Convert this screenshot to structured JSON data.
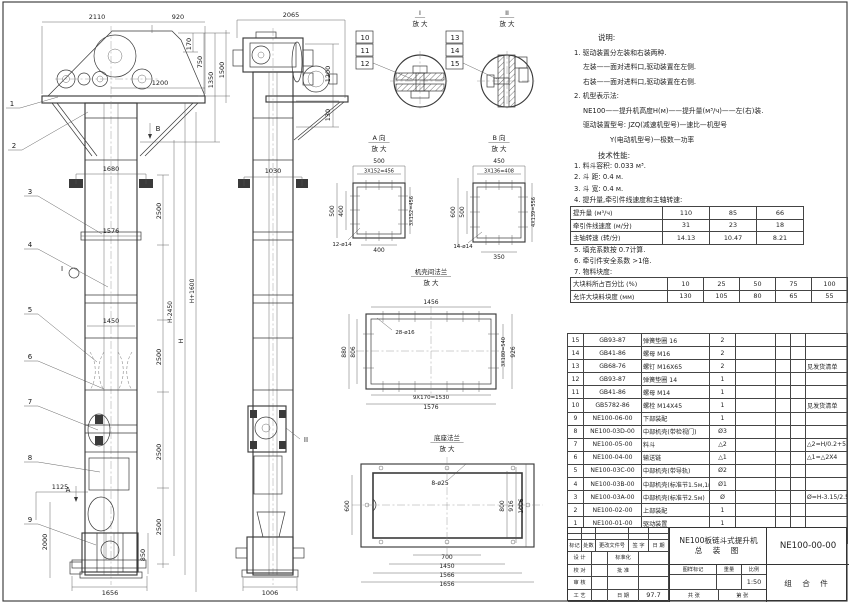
{
  "sheet": {
    "paper_color": "#ffffff",
    "ink_color": "#3a3a3a"
  },
  "notes": {
    "title": "说明:",
    "lines": [
      {
        "t": "1. 驱动装置分左装和右装两种.",
        "i": 0
      },
      {
        "t": "左装——面对进料口,驱动装置在左侧.",
        "i": 1
      },
      {
        "t": "右装——面对进料口,驱动装置在右侧.",
        "i": 1
      },
      {
        "t": "2. 机型表示法:",
        "i": 0
      },
      {
        "t": "NE100——提升机高度H(м)——提升量(м³/ч)——左(右)装.",
        "i": 1
      },
      {
        "t": "驱动装置型号: JZQ(减速机型号)—速比—机型号",
        "i": 1
      },
      {
        "t": "Y(电动机型号)—极数—功率",
        "i": 4
      }
    ]
  },
  "tech": {
    "title": "技术性能:",
    "lines": [
      {
        "t": "1. 料斗容积: 0.033 м³.",
        "i": 0
      },
      {
        "t": "2. 斗  距: 0.4 м.",
        "i": 0
      },
      {
        "t": "3. 斗  宽: 0.4 м.",
        "i": 0
      },
      {
        "t": "4. 提升量,牵引件线速度和主轴转速:",
        "i": 0
      }
    ],
    "lines2": [
      {
        "t": "5. 填充系数按 0.7计算.",
        "i": 0
      },
      {
        "t": "6. 牵引件安全系数 >1倍.",
        "i": 0
      },
      {
        "t": "7. 物料块度:",
        "i": 0
      }
    ]
  },
  "capacity_table": {
    "rows": [
      [
        "提升量 (м³/ч)",
        "110",
        "85",
        "66"
      ],
      [
        "牵引件线速度 (м/分)",
        "31",
        "23",
        "18"
      ],
      [
        "主轴转速 (转/分)",
        "14.13",
        "10.47",
        "8.21"
      ]
    ]
  },
  "lump_table": {
    "rows": [
      [
        "大块料所占百分比 (%)",
        "10",
        "25",
        "50",
        "75",
        "100"
      ],
      [
        "允许大块料块度 (мм)",
        "130",
        "105",
        "80",
        "65",
        "55"
      ]
    ]
  },
  "bom": {
    "headers": [
      "序号",
      "代  号",
      "名  称",
      "数量",
      "材  料",
      "单重",
      "总重",
      "备  注"
    ],
    "rows": [
      [
        "15",
        "GB93-87",
        "弹簧垫圈 16",
        "2",
        "",
        "",
        "",
        ""
      ],
      [
        "14",
        "GB41-86",
        "螺母 M16",
        "2",
        "",
        "",
        "",
        ""
      ],
      [
        "13",
        "GB68-76",
        "螺钉 M16X65",
        "2",
        "",
        "",
        "",
        "见发货清单"
      ],
      [
        "12",
        "GB93-87",
        "弹簧垫圈 14",
        "1",
        "",
        "",
        "",
        ""
      ],
      [
        "11",
        "GB41-86",
        "螺母 M14",
        "1",
        "",
        "",
        "",
        ""
      ],
      [
        "10",
        "GB5782-86",
        "螺栓 M14X45",
        "1",
        "",
        "",
        "",
        "见发货清单"
      ],
      [
        "9",
        "NE100-06-00",
        "下部装配",
        "1",
        "",
        "",
        "",
        ""
      ],
      [
        "8",
        "NE100-03D-00",
        "中部机壳(带检视门)",
        "Ø3",
        "",
        "",
        "",
        ""
      ],
      [
        "7",
        "NE100-05-00",
        "料斗",
        "△2",
        "",
        "",
        "",
        "△2=H/0.2+5.75"
      ],
      [
        "6",
        "NE100-04-00",
        "输送链",
        "△1",
        "",
        "",
        "",
        "△1=△2X4"
      ],
      [
        "5",
        "NE100-03C-00",
        "中部机壳(带导轨)",
        "Ø2",
        "",
        "",
        "",
        ""
      ],
      [
        "4",
        "NE100-03B-00",
        "中部机壳(标准节1.5м,1м)",
        "Ø1",
        "",
        "",
        "",
        ""
      ],
      [
        "3",
        "NE100-03A-00",
        "中部机壳(标准节2.5м)",
        "Ø",
        "",
        "",
        "",
        "Ø=H-3.15/2.5"
      ],
      [
        "2",
        "NE100-02-00",
        "上部装配",
        "1",
        "",
        "",
        "",
        ""
      ],
      [
        "1",
        "NE100-01-00",
        "驱动装置",
        "1",
        "",
        "",
        "",
        ""
      ]
    ]
  },
  "title_block": {
    "product": "NE100板链斗式提升机",
    "drawing_type": "总 装 图",
    "drawing_no": "NE100-00-00",
    "part_class": "组 合 件",
    "scale_value": "1:50",
    "date_value": "97.7",
    "h_mark": "标记",
    "h_count": "处数",
    "h_doc": "更改文件号",
    "h_sign": "签 字",
    "h_date": "日 期",
    "design": "设 计",
    "standard": "标准化",
    "check": "校 对",
    "approve": "批 准",
    "review": "审 核",
    "craft": "工 艺",
    "date_lbl": "日 期",
    "stamp": "图样标记",
    "weight": "重量",
    "ratio": "比例",
    "sheets": "共  张",
    "sheet_no": "第  张"
  },
  "drawing": {
    "view_titles": [
      {
        "a": "I",
        "b": "放 大",
        "x": 420,
        "y": 15
      },
      {
        "a": "II",
        "b": "放 大",
        "x": 507,
        "y": 15
      },
      {
        "a": "A 向",
        "b": "放 大",
        "x": 379,
        "y": 140
      },
      {
        "a": "B 向",
        "b": "放 大",
        "x": 499,
        "y": 140
      },
      {
        "a": "机壳间法兰",
        "b": "放 大",
        "x": 431,
        "y": 274
      },
      {
        "a": "底座法兰",
        "b": "放 大",
        "x": 447,
        "y": 440
      }
    ],
    "labels": [
      {
        "t": "2110",
        "x": 97,
        "y": 19
      },
      {
        "t": "920",
        "x": 178,
        "y": 19
      },
      {
        "t": "170",
        "x": 191,
        "y": 44,
        "r": 1
      },
      {
        "t": "750",
        "x": 202,
        "y": 62,
        "r": 1
      },
      {
        "t": "1350",
        "x": 213,
        "y": 80,
        "r": 1
      },
      {
        "t": "1500",
        "x": 224,
        "y": 70,
        "r": 1
      },
      {
        "t": "1200",
        "x": 160,
        "y": 85
      },
      {
        "t": "1680",
        "x": 111,
        "y": 171
      },
      {
        "t": "2500",
        "x": 161,
        "y": 211,
        "r": 1
      },
      {
        "t": "1576",
        "x": 111,
        "y": 233
      },
      {
        "t": "H-2450",
        "x": 172,
        "y": 312,
        "r": 1,
        "fs": 6
      },
      {
        "t": "H",
        "x": 183,
        "y": 341,
        "r": 1
      },
      {
        "t": "H+1600",
        "x": 194,
        "y": 291,
        "r": 1,
        "fs": 6
      },
      {
        "t": "1450",
        "x": 111,
        "y": 323
      },
      {
        "t": "2500",
        "x": 161,
        "y": 357,
        "r": 1
      },
      {
        "t": "2500",
        "x": 161,
        "y": 452,
        "r": 1
      },
      {
        "t": "2500",
        "x": 161,
        "y": 527,
        "r": 1
      },
      {
        "t": "1125",
        "x": 60,
        "y": 489
      },
      {
        "t": "2000",
        "x": 47,
        "y": 542,
        "r": 1
      },
      {
        "t": "850",
        "x": 145,
        "y": 555,
        "r": 1
      },
      {
        "t": "1656",
        "x": 110,
        "y": 595
      },
      {
        "t": "2065",
        "x": 291,
        "y": 17
      },
      {
        "t": "1200",
        "x": 330,
        "y": 74,
        "r": 1
      },
      {
        "t": "130",
        "x": 330,
        "y": 115,
        "r": 1
      },
      {
        "t": "1030",
        "x": 273,
        "y": 173
      },
      {
        "t": "1006",
        "x": 270,
        "y": 595
      },
      {
        "t": "500",
        "x": 379,
        "y": 163,
        "fs": 6
      },
      {
        "t": "3X152=456",
        "x": 379,
        "y": 172.5,
        "fs": 5
      },
      {
        "t": "500",
        "x": 334,
        "y": 211,
        "r": 1,
        "fs": 6
      },
      {
        "t": "400",
        "x": 343,
        "y": 211,
        "r": 1,
        "fs": 6
      },
      {
        "t": "3X152=456",
        "x": 413,
        "y": 211,
        "r": 1,
        "fs": 5
      },
      {
        "t": "400",
        "x": 379,
        "y": 252,
        "fs": 6
      },
      {
        "t": "12-ø14",
        "x": 342,
        "y": 246,
        "fs": 5.5
      },
      {
        "t": "450",
        "x": 499,
        "y": 163,
        "fs": 6
      },
      {
        "t": "3X136=408",
        "x": 499,
        "y": 172.5,
        "fs": 5
      },
      {
        "t": "600",
        "x": 455,
        "y": 212,
        "r": 1,
        "fs": 6
      },
      {
        "t": "500",
        "x": 464,
        "y": 212,
        "r": 1,
        "fs": 6
      },
      {
        "t": "4X139=556",
        "x": 535,
        "y": 212,
        "r": 1,
        "fs": 5
      },
      {
        "t": "350",
        "x": 499,
        "y": 259,
        "fs": 6
      },
      {
        "t": "14-ø14",
        "x": 463,
        "y": 248,
        "fs": 5.5
      },
      {
        "t": "1456",
        "x": 431,
        "y": 304,
        "fs": 6
      },
      {
        "t": "28-ø16",
        "x": 405,
        "y": 334,
        "fs": 5.5
      },
      {
        "t": "880",
        "x": 346,
        "y": 352,
        "r": 1,
        "fs": 6
      },
      {
        "t": "806",
        "x": 355,
        "y": 352,
        "r": 1,
        "fs": 6
      },
      {
        "t": "3X180=540",
        "x": 505,
        "y": 352,
        "r": 1,
        "fs": 5
      },
      {
        "t": "926",
        "x": 515,
        "y": 352,
        "r": 1,
        "fs": 6
      },
      {
        "t": "9X170=1530",
        "x": 431,
        "y": 399,
        "fs": 5.5
      },
      {
        "t": "1576",
        "x": 431,
        "y": 409,
        "fs": 6
      },
      {
        "t": "8-ø25",
        "x": 440,
        "y": 485,
        "fs": 6
      },
      {
        "t": "600",
        "x": 349,
        "y": 506,
        "r": 1,
        "fs": 6
      },
      {
        "t": "800",
        "x": 504,
        "y": 506,
        "r": 1,
        "fs": 6
      },
      {
        "t": "916",
        "x": 513,
        "y": 506,
        "r": 1,
        "fs": 6
      },
      {
        "t": "1006",
        "x": 523,
        "y": 506,
        "r": 1,
        "fs": 6
      },
      {
        "t": "700",
        "x": 447,
        "y": 559,
        "fs": 6
      },
      {
        "t": "1450",
        "x": 447,
        "y": 568,
        "fs": 6
      },
      {
        "t": "1566",
        "x": 447,
        "y": 577,
        "fs": 6
      },
      {
        "t": "1656",
        "x": 447,
        "y": 586,
        "fs": 6
      }
    ],
    "callouts": [
      {
        "t": "1",
        "x": 12,
        "y": 106
      },
      {
        "t": "2",
        "x": 14,
        "y": 148
      },
      {
        "t": "3",
        "x": 30,
        "y": 194
      },
      {
        "t": "4",
        "x": 30,
        "y": 247
      },
      {
        "t": "5",
        "x": 30,
        "y": 312
      },
      {
        "t": "6",
        "x": 30,
        "y": 359
      },
      {
        "t": "7",
        "x": 30,
        "y": 404
      },
      {
        "t": "8",
        "x": 30,
        "y": 460
      },
      {
        "t": "9",
        "x": 30,
        "y": 522
      },
      {
        "t": "10",
        "x": 365,
        "y": 40
      },
      {
        "t": "11",
        "x": 365,
        "y": 53
      },
      {
        "t": "12",
        "x": 365,
        "y": 66
      },
      {
        "t": "13",
        "x": 455,
        "y": 40
      },
      {
        "t": "14",
        "x": 455,
        "y": 53
      },
      {
        "t": "15",
        "x": 455,
        "y": 66
      },
      {
        "t": "A",
        "x": 68,
        "y": 492
      },
      {
        "t": "B",
        "x": 158,
        "y": 131
      },
      {
        "t": "I",
        "x": 62,
        "y": 271
      },
      {
        "t": "II",
        "x": 306,
        "y": 442
      }
    ]
  }
}
